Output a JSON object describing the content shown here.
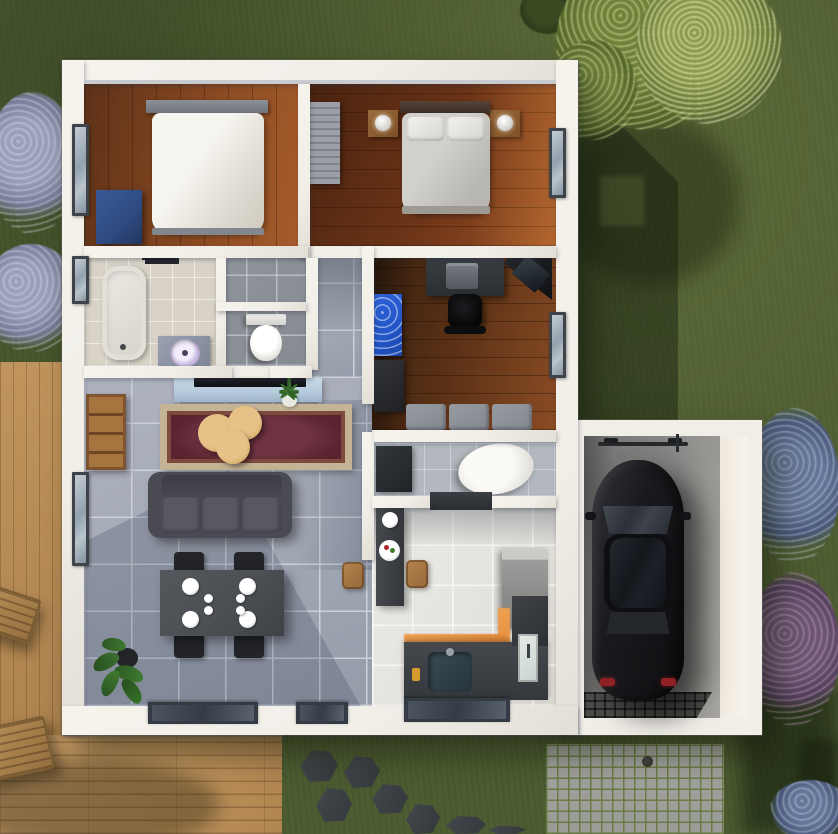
{
  "scene": {
    "type": "top-down-3d-floor-plan-render",
    "lot": {
      "lawn": "green-grass",
      "deck": {
        "position": "left-and-bottom-left",
        "material": "wood-planks",
        "lounge_chairs": 2
      },
      "driveway": {
        "position": "below-garage",
        "material": "cobblestone-pavers",
        "drain_caps": 1
      },
      "stepping_stones": {
        "count": 7,
        "color": "dark-slate",
        "area": "bottom-center-lawn"
      },
      "vegetation": {
        "tree_top_right": "flowering-green-tree",
        "shrub_top_center": "dark-green-shrub",
        "bushes_left_count": 2,
        "bushes_right": [
          "blue-flowering-bush",
          "purple-flowering-bush"
        ],
        "indoor_plants": 2
      },
      "shadows": [
        "house-shadow-on-right-lawn",
        "tree-shadow-bottom-right",
        "tree-shadow-on-deck"
      ]
    },
    "house": {
      "rooms": [
        {
          "name": "bedroom-1",
          "floor": "medium-brown-wood",
          "contents": [
            "double-bed-white-duvet",
            "gray-headboard",
            "gray-pillows-x2",
            "blue-dresser",
            "left-window"
          ]
        },
        {
          "name": "bedroom-2",
          "floor": "dark-red-brown-wood",
          "contents": [
            "double-bed-gray-duvet",
            "white-pillows-x2",
            "wood-nightstands-x2",
            "white-lamps-x2",
            "slatted-wardrobe",
            "right-window"
          ]
        },
        {
          "name": "bathroom",
          "floor": "beige-tile",
          "contents": [
            "bathtub",
            "vanity",
            "round-lavender-sink",
            "black-wall-shelf",
            "left-window"
          ]
        },
        {
          "name": "shower-room",
          "floor": "gray-tile",
          "contents": []
        },
        {
          "name": "wc",
          "floor": "gray-tile",
          "contents": [
            "toilet"
          ]
        },
        {
          "name": "office",
          "floor": "dark-wood",
          "contents": [
            "desk",
            "printer",
            "corner-monitor-desk",
            "black-office-chair",
            "blue-pegboard",
            "black-cabinet",
            "gray-bench-3-cushions",
            "right-window"
          ]
        },
        {
          "name": "laundry",
          "floor": "gray-tile",
          "contents": [
            "washing-machine",
            "white-oval-basin",
            "door-mat"
          ]
        },
        {
          "name": "kitchen",
          "floor": "white-tile",
          "contents": [
            "bar-table",
            "fruit-plate",
            "wood-stools-x2",
            "fridge",
            "l-shaped-counter",
            "sink",
            "orange-backsplash",
            "white-door-cabinet",
            "bottom-window"
          ]
        },
        {
          "name": "living-dining",
          "floor": "blue-gray-tile",
          "contents": [
            "glass-tv-console",
            "tv",
            "palm-plant",
            "oriental-red-rug",
            "round-coffee-tables-x3",
            "gray-sofa",
            "wood-bookshelf",
            "dining-table",
            "black-chairs-x4",
            "large-plates-x4",
            "small-plates-x4",
            "potted-plant",
            "left-window",
            "bottom-glass-doors-x2"
          ]
        },
        {
          "name": "garage",
          "floor": "concrete",
          "contents": [
            "black-car-top-view",
            "bicycle",
            "floor-grate"
          ]
        }
      ]
    }
  },
  "palette": {
    "grass": "#4d5c31",
    "wall": "#f1eee8",
    "woodBed1": "#8a4a22",
    "woodBed2": "#6e3518",
    "woodOffice": "#5e3317",
    "tileLiving": "#a2a8b4",
    "grout": "#ccd1da",
    "tileBath": "#d8d3c6",
    "tileGray": "#868b92",
    "tileKitchen": "#e4e2dd",
    "tileUtility": "#b3b8bf",
    "deck": "#c0945c",
    "cobble": "#9a9a96",
    "concrete": "#8f8f8d",
    "rugRed": "#5c2531",
    "rugBorder": "#c4b394",
    "tableTan": "#d9b26f",
    "sofaGray": "#4a4a52",
    "diningGray": "#4b4e53",
    "chairBlack": "#222428",
    "carBlack": "#131316",
    "orangeAccent": "#e08a3c",
    "dresserBlue": "#2e4a80",
    "pegboardBlue": "#2256c8",
    "glassBlue": "#b5cbdc"
  }
}
